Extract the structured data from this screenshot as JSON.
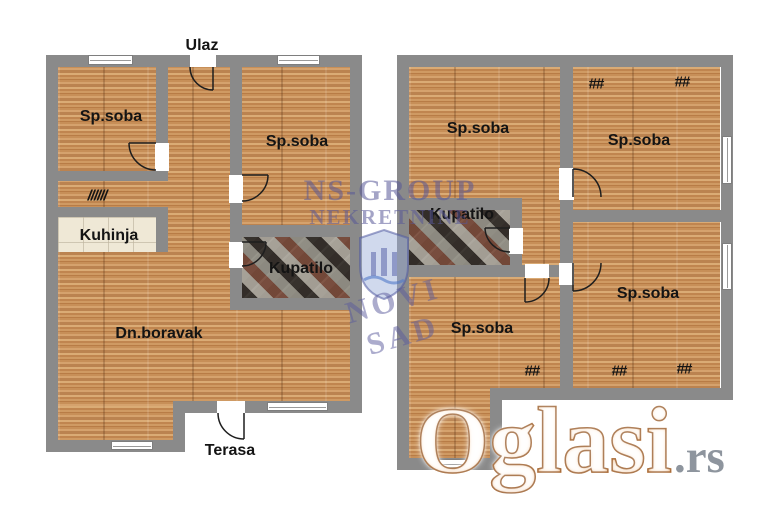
{
  "left_plan": {
    "entrance_label": "Ulaz",
    "terrace_label": "Terasa",
    "bedroom1_label": "Sp.soba",
    "bedroom2_label": "Sp.soba",
    "kitchen_label": "Kuhinja",
    "bathroom_label": "Kupatilo",
    "living_room_label": "Dn.boravak",
    "vent_hatch_label": "//////"
  },
  "right_plan": {
    "bedroom1_label": "Sp.soba",
    "bedroom2_label": "Sp.soba",
    "bedroom3_label": "Sp.soba",
    "bedroom4_label": "Sp.soba",
    "bathroom_label": "Kupatilo",
    "window_mark1": "##",
    "window_mark2": "##",
    "window_mark3": "##",
    "window_mark4": "##",
    "window_mark5": "##"
  },
  "watermarks": {
    "agency_name": "NS-GROUP",
    "agency_type": "NEKRETNINE",
    "agency_city": "NOVI SAD",
    "portal_name": "Oglasi",
    "portal_domain": ".rs"
  },
  "colors": {
    "wall": "#8a8a8a",
    "wood_floor": "#c68f5c",
    "kitchen_tile": "#efe8d6",
    "portal_orange": "#ec9347"
  }
}
